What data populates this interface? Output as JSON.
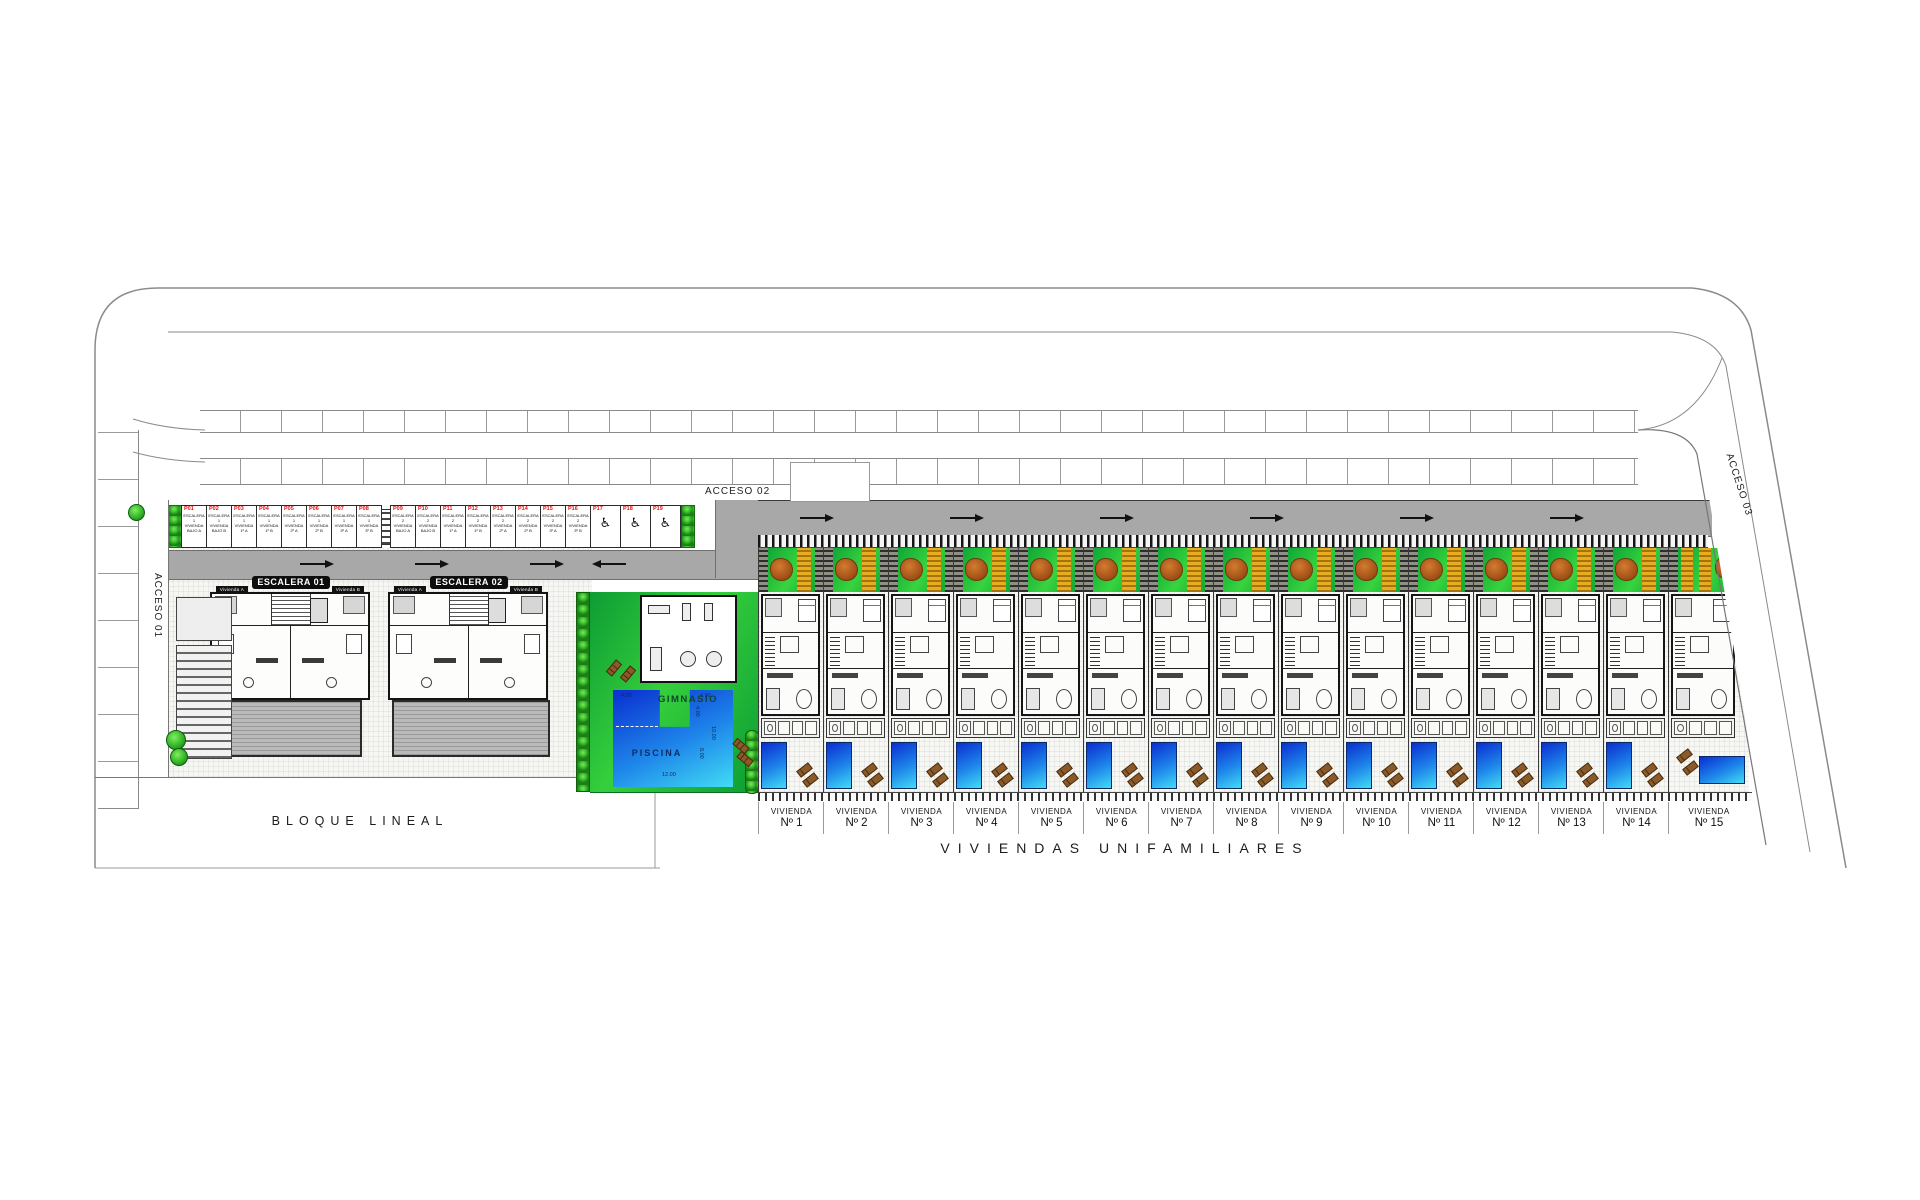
{
  "titles": {
    "bloque_lineal": "BLOQUE LINEAL",
    "viviendas_row": "VIVIENDAS UNIFAMILIARES"
  },
  "accesses": {
    "a1": "ACCESO 01",
    "a2": "ACCESO 02",
    "a3": "ACCESO 03"
  },
  "labels": {
    "bicicletas": "BICICLETAS",
    "gimnasio": "GIMNASIO",
    "piscina": "PISCINA"
  },
  "escaleras": [
    {
      "label": "ESCALERA 01"
    },
    {
      "label": "ESCALERA 02"
    }
  ],
  "apartment_unit_chips": [
    "Vivienda A",
    "Vivienda B",
    "Vivienda A",
    "Vivienda B"
  ],
  "pool_dimensions": {
    "top_left": "4.00",
    "top_right": "4.90",
    "notch": "4.00",
    "right_height": "10.00",
    "body_height": "8.00",
    "bottom_width": "12.00"
  },
  "parking": {
    "stalls": [
      {
        "id": "P01",
        "l1": "ESCALERA 1",
        "l2": "VIVIENDA",
        "l3": "BAJO A"
      },
      {
        "id": "P02",
        "l1": "ESCALERA 1",
        "l2": "VIVIENDA",
        "l3": "BAJO B"
      },
      {
        "id": "P03",
        "l1": "ESCALERA 1",
        "l2": "VIVIENDA",
        "l3": "1º A"
      },
      {
        "id": "P04",
        "l1": "ESCALERA 1",
        "l2": "VIVIENDA",
        "l3": "1º B"
      },
      {
        "id": "P05",
        "l1": "ESCALERA 1",
        "l2": "VIVIENDA",
        "l3": "2º A"
      },
      {
        "id": "P06",
        "l1": "ESCALERA 1",
        "l2": "VIVIENDA",
        "l3": "2º B"
      },
      {
        "id": "P07",
        "l1": "ESCALERA 1",
        "l2": "VIVIENDA",
        "l3": "3º A"
      },
      {
        "id": "P08",
        "l1": "ESCALERA 1",
        "l2": "VIVIENDA",
        "l3": "3º B"
      },
      {
        "type": "stairs"
      },
      {
        "id": "P09",
        "l1": "ESCALERA 2",
        "l2": "VIVIENDA",
        "l3": "BAJO A"
      },
      {
        "id": "P10",
        "l1": "ESCALERA 2",
        "l2": "VIVIENDA",
        "l3": "BAJO B"
      },
      {
        "id": "P11",
        "l1": "ESCALERA 2",
        "l2": "VIVIENDA",
        "l3": "1º A"
      },
      {
        "id": "P12",
        "l1": "ESCALERA 2",
        "l2": "VIVIENDA",
        "l3": "1º B"
      },
      {
        "id": "P13",
        "l1": "ESCALERA 2",
        "l2": "VIVIENDA",
        "l3": "2º A"
      },
      {
        "id": "P14",
        "l1": "ESCALERA 2",
        "l2": "VIVIENDA",
        "l3": "2º B"
      },
      {
        "id": "P15",
        "l1": "ESCALERA 2",
        "l2": "VIVIENDA",
        "l3": "3º A"
      },
      {
        "id": "P16",
        "l1": "ESCALERA 2",
        "l2": "VIVIENDA",
        "l3": "3º B"
      },
      {
        "id": "P17",
        "icon": "wheelchair"
      },
      {
        "id": "P18",
        "icon": "wheelchair"
      },
      {
        "id": "P19",
        "icon": "wheelchair"
      }
    ]
  },
  "villas": {
    "units": [
      {
        "name": "VIVIENDA",
        "number": "Nº 1"
      },
      {
        "name": "VIVIENDA",
        "number": "Nº 2"
      },
      {
        "name": "VIVIENDA",
        "number": "Nº 3"
      },
      {
        "name": "VIVIENDA",
        "number": "Nº 4"
      },
      {
        "name": "VIVIENDA",
        "number": "Nº 5"
      },
      {
        "name": "VIVIENDA",
        "number": "Nº 6"
      },
      {
        "name": "VIVIENDA",
        "number": "Nº 7"
      },
      {
        "name": "VIVIENDA",
        "number": "Nº 8"
      },
      {
        "name": "VIVIENDA",
        "number": "Nº 9"
      },
      {
        "name": "VIVIENDA",
        "number": "Nº 10"
      },
      {
        "name": "VIVIENDA",
        "number": "Nº 11"
      },
      {
        "name": "VIVIENDA",
        "number": "Nº 12"
      },
      {
        "name": "VIVIENDA",
        "number": "Nº 13"
      },
      {
        "name": "VIVIENDA",
        "number": "Nº 14"
      },
      {
        "name": "VIVIENDA",
        "number": "Nº 15"
      }
    ]
  },
  "colors": {
    "lawn": "#1db13a",
    "pool_deep": "#0a2ed0",
    "pool_light": "#41dcf4",
    "road": "#a8a8a8",
    "tree": "#c4671f",
    "pergola": "#e7ad1e",
    "stall_id_red": "#e01414",
    "hedge": "#2fae25"
  }
}
